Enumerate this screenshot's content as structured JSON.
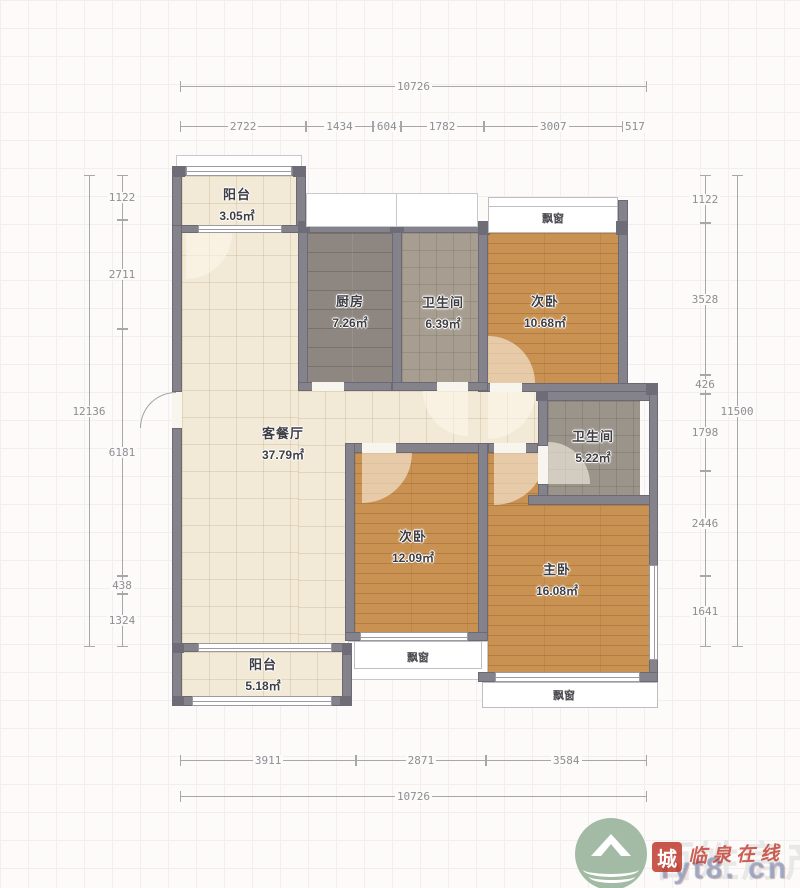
{
  "rooms": {
    "balcony_top": {
      "name": "阳台",
      "area": "3.05㎡"
    },
    "kitchen": {
      "name": "厨房",
      "area": "7.26㎡"
    },
    "bath_top": {
      "name": "卫生间",
      "area": "6.39㎡"
    },
    "bedroom_top": {
      "name": "次卧",
      "area": "10.68㎡"
    },
    "living": {
      "name": "客餐厅",
      "area": "37.79㎡"
    },
    "bath_mid": {
      "name": "卫生间",
      "area": "5.22㎡"
    },
    "bedroom_mid": {
      "name": "次卧",
      "area": "12.09㎡"
    },
    "master": {
      "name": "主卧",
      "area": "16.08㎡"
    },
    "balcony_bottom": {
      "name": "阳台",
      "area": "5.18㎡"
    }
  },
  "bay_windows": {
    "top": "飘窗",
    "mid": "飘窗",
    "bottom": "飘窗"
  },
  "dimensions": {
    "top": {
      "overall": "10726",
      "segments": [
        "2722",
        "1434",
        "604",
        "1782",
        "3007",
        "517"
      ]
    },
    "bottom": {
      "overall": "10726",
      "segments": [
        "3911",
        "2871",
        "3584"
      ]
    },
    "left": {
      "overall": "12136",
      "segments": [
        "1122",
        "2711",
        "6181",
        "438",
        "1324"
      ]
    },
    "right": {
      "overall": "11500",
      "segments": [
        "1122",
        "3528",
        "426",
        "1798",
        "2446",
        "1641"
      ]
    }
  },
  "watermark": {
    "brand": "百姓房产",
    "stamp": "城",
    "site": "临泉在线",
    "url": "fyt8. cn"
  },
  "colors": {
    "wall": "#84838c",
    "wood_floor": "#c99252",
    "cream_floor": "#f2e9d6",
    "kitchen_floor": "#8e8781",
    "bath_floor": "#a79e91",
    "watermark_red": "#c0392b",
    "logo_green": "#a3bba4"
  }
}
